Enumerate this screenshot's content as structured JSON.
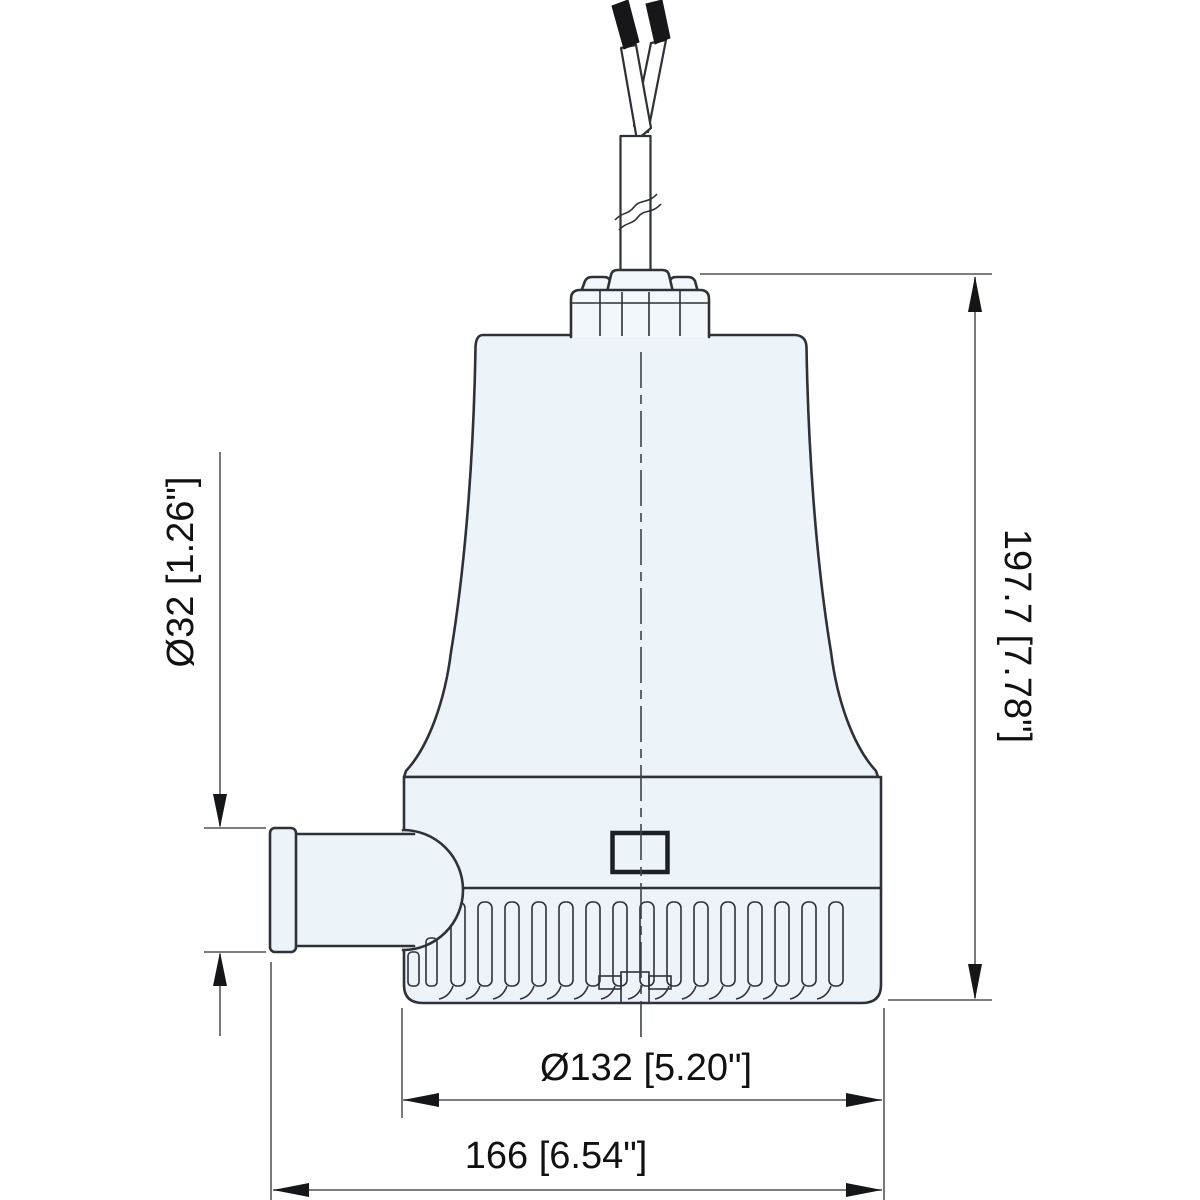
{
  "drawing": {
    "type": "technical-dimension-drawing",
    "subject": "submersible bilge pump side elevation",
    "labels": {
      "outlet_diameter": "Ø32 [1.26\"]",
      "overall_height": "197.7 [7.78\"]",
      "strainer_diameter": "Ø132 [5.20\"]",
      "overall_width": "166 [6.54\"]"
    },
    "colors": {
      "background": "#ffffff",
      "body_fill": "#ecf4fa",
      "outline": "#2e3238",
      "dimension_line": "#6b6b6b",
      "arrowhead": "#14161a",
      "text": "#111111",
      "wire_tip": "#17171a"
    }
  }
}
